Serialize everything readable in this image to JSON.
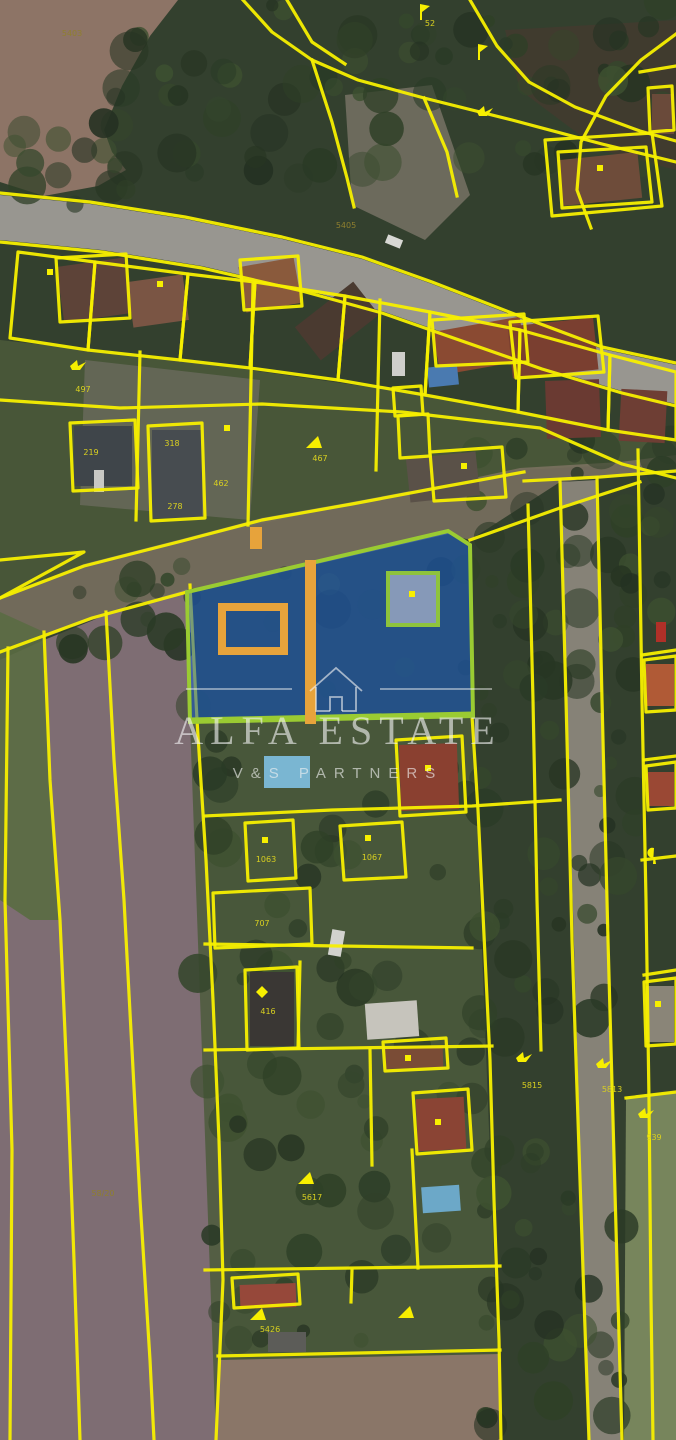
{
  "watermark": {
    "brand": "ALFA ESTATE",
    "subbrand": "V&S PARTNERS",
    "logo": "house-outline-icon"
  },
  "colors": {
    "cadastral_line": "#f7ef00",
    "parcel_label": "#d9d020",
    "parcel_label_muted": "#8f7f2e",
    "highlight_fill": "#1a5fd0",
    "highlight_fill_opacity": "0.55",
    "highlight_border": "#9acb32",
    "highlight_building_border": "#8ec33c",
    "annotation_orange": "#e7a33b",
    "watermark": "rgba(242,242,242,0.62)"
  },
  "parcel_labels": [
    {
      "text": "5403",
      "x": 72,
      "y": 36,
      "muted": true
    },
    {
      "text": "52",
      "x": 430,
      "y": 26
    },
    {
      "text": "5405",
      "x": 346,
      "y": 228,
      "muted": true
    },
    {
      "text": "497",
      "x": 83,
      "y": 392
    },
    {
      "text": "219",
      "x": 91,
      "y": 455
    },
    {
      "text": "318",
      "x": 172,
      "y": 446
    },
    {
      "text": "462",
      "x": 221,
      "y": 486
    },
    {
      "text": "278",
      "x": 175,
      "y": 509
    },
    {
      "text": "467",
      "x": 320,
      "y": 461
    },
    {
      "text": "1063",
      "x": 266,
      "y": 862
    },
    {
      "text": "1067",
      "x": 372,
      "y": 860
    },
    {
      "text": "707",
      "x": 262,
      "y": 926
    },
    {
      "text": "416",
      "x": 268,
      "y": 1014
    },
    {
      "text": "58/20",
      "x": 103,
      "y": 1196,
      "muted": true
    },
    {
      "text": "5617",
      "x": 312,
      "y": 1200
    },
    {
      "text": "5815",
      "x": 532,
      "y": 1088
    },
    {
      "text": "5813",
      "x": 612,
      "y": 1092
    },
    {
      "text": "939",
      "x": 654,
      "y": 1140
    },
    {
      "text": "5426",
      "x": 270,
      "y": 1332
    }
  ],
  "map_symbols": [
    {
      "icon": "flag-symbol-icon",
      "x": 428,
      "y": 12
    },
    {
      "icon": "flag-symbol-icon",
      "x": 486,
      "y": 52
    },
    {
      "icon": "bird-symbol-icon",
      "x": 485,
      "y": 114
    },
    {
      "icon": "bird-symbol-icon",
      "x": 78,
      "y": 368
    },
    {
      "icon": "triangle-symbol-icon",
      "x": 314,
      "y": 444
    },
    {
      "icon": "triangle-symbol-icon",
      "x": 306,
      "y": 1180
    },
    {
      "icon": "bird-symbol-icon",
      "x": 524,
      "y": 1060
    },
    {
      "icon": "bird-symbol-icon",
      "x": 604,
      "y": 1066
    },
    {
      "icon": "bird-symbol-icon",
      "x": 646,
      "y": 1116
    },
    {
      "icon": "triangle-symbol-icon",
      "x": 258,
      "y": 1316
    },
    {
      "icon": "triangle-symbol-icon",
      "x": 406,
      "y": 1314
    },
    {
      "icon": "hook-symbol-icon",
      "x": 658,
      "y": 856
    },
    {
      "icon": "diamond-symbol-icon",
      "x": 264,
      "y": 994
    }
  ],
  "building_markers": [
    {
      "x": 50,
      "y": 272
    },
    {
      "x": 160,
      "y": 284
    },
    {
      "x": 227,
      "y": 428
    },
    {
      "x": 412,
      "y": 594
    },
    {
      "x": 428,
      "y": 768
    },
    {
      "x": 600,
      "y": 168
    },
    {
      "x": 464,
      "y": 466
    },
    {
      "x": 265,
      "y": 840
    },
    {
      "x": 368,
      "y": 838
    },
    {
      "x": 438,
      "y": 1122
    },
    {
      "x": 658,
      "y": 1004
    },
    {
      "x": 408,
      "y": 1058
    }
  ]
}
